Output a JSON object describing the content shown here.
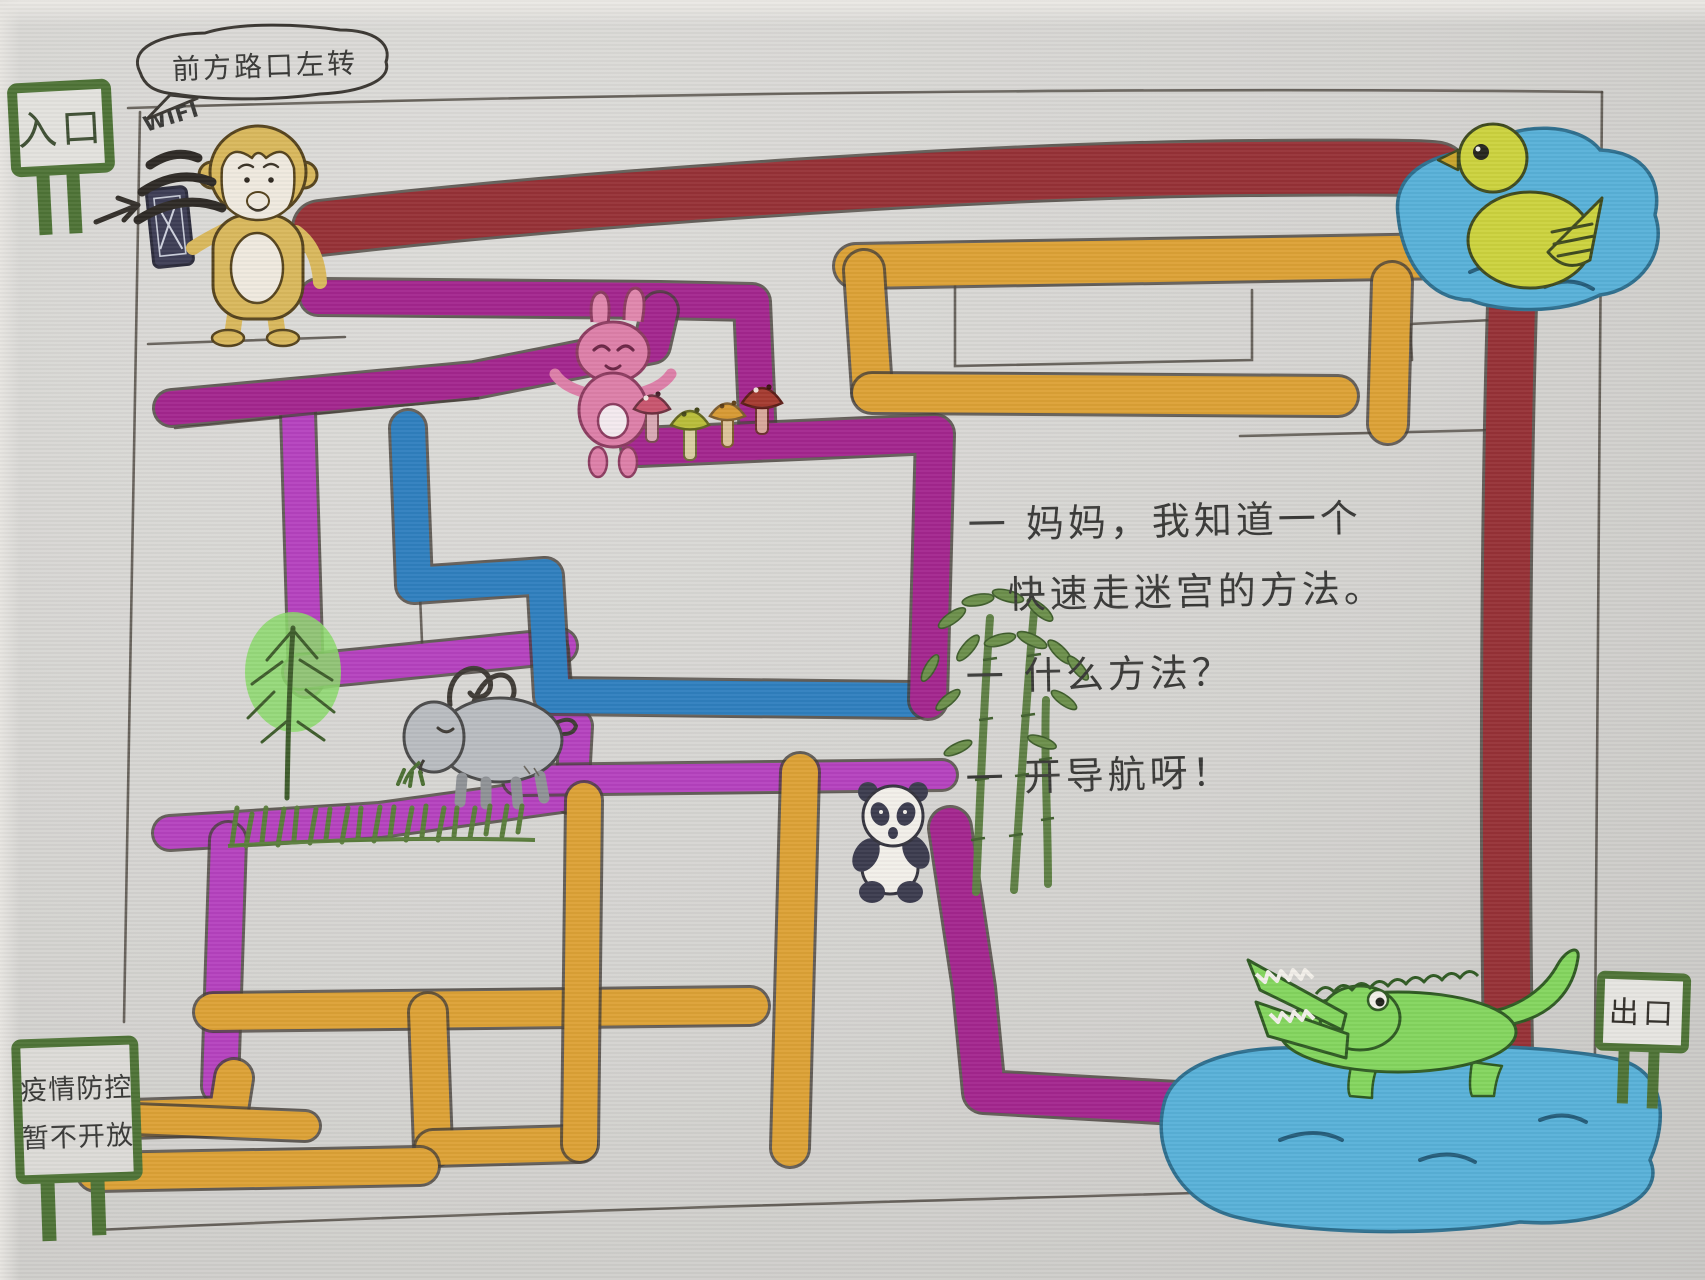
{
  "speech_bubble": {
    "text": "前方路口左转"
  },
  "labels": {
    "wifi": "WIFI"
  },
  "signs": {
    "entrance": {
      "text": "入口"
    },
    "exit": {
      "text": "出口"
    },
    "closed": {
      "line1": "疫情防控",
      "line2": "暂不开放"
    }
  },
  "dialogue": {
    "line1": "一 妈妈，我知道一个",
    "line2": "快速走迷宫的方法。",
    "line3": "一 什么方法？",
    "line4": "一 开导航呀！"
  },
  "colors": {
    "maroon": "#963136",
    "orange": "#dca135",
    "magenta": "#a3268e",
    "violet": "#b542be",
    "blue": "#2f7fbe",
    "sign_green": "#4e7336",
    "water": "#58b1d8",
    "pencil": "#4a463f"
  }
}
